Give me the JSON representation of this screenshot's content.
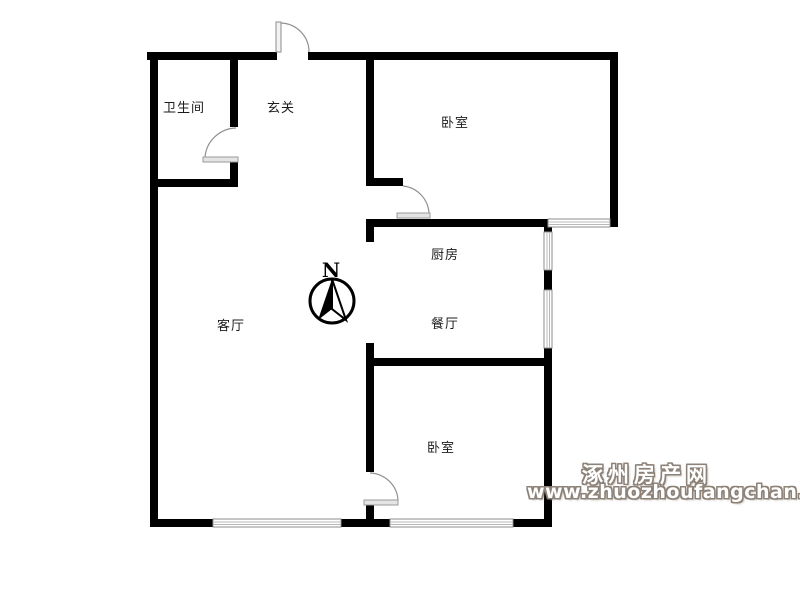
{
  "floorplan": {
    "title": "residential floor plan",
    "rooms": [
      {
        "id": "bathroom",
        "label": "卫生间"
      },
      {
        "id": "entry-hall",
        "label": "玄关"
      },
      {
        "id": "bedroom-top",
        "label": "卧室"
      },
      {
        "id": "kitchen",
        "label": "厨房"
      },
      {
        "id": "dining-room",
        "label": "餐厅"
      },
      {
        "id": "living-room",
        "label": "客厅"
      },
      {
        "id": "bedroom-bottom",
        "label": "卧室"
      }
    ],
    "compass": {
      "north_label": "N"
    },
    "watermark": {
      "site_name": "涿州房产网",
      "site_url": "www.zhuozhoufangchan.com"
    },
    "colors": {
      "wall": "#000000",
      "door_arc": "#909090",
      "door_leaf": "#e4e4e4",
      "window_frame": "#8c8c8c",
      "watermark": "#8d8278",
      "background": "#ffffff"
    }
  }
}
